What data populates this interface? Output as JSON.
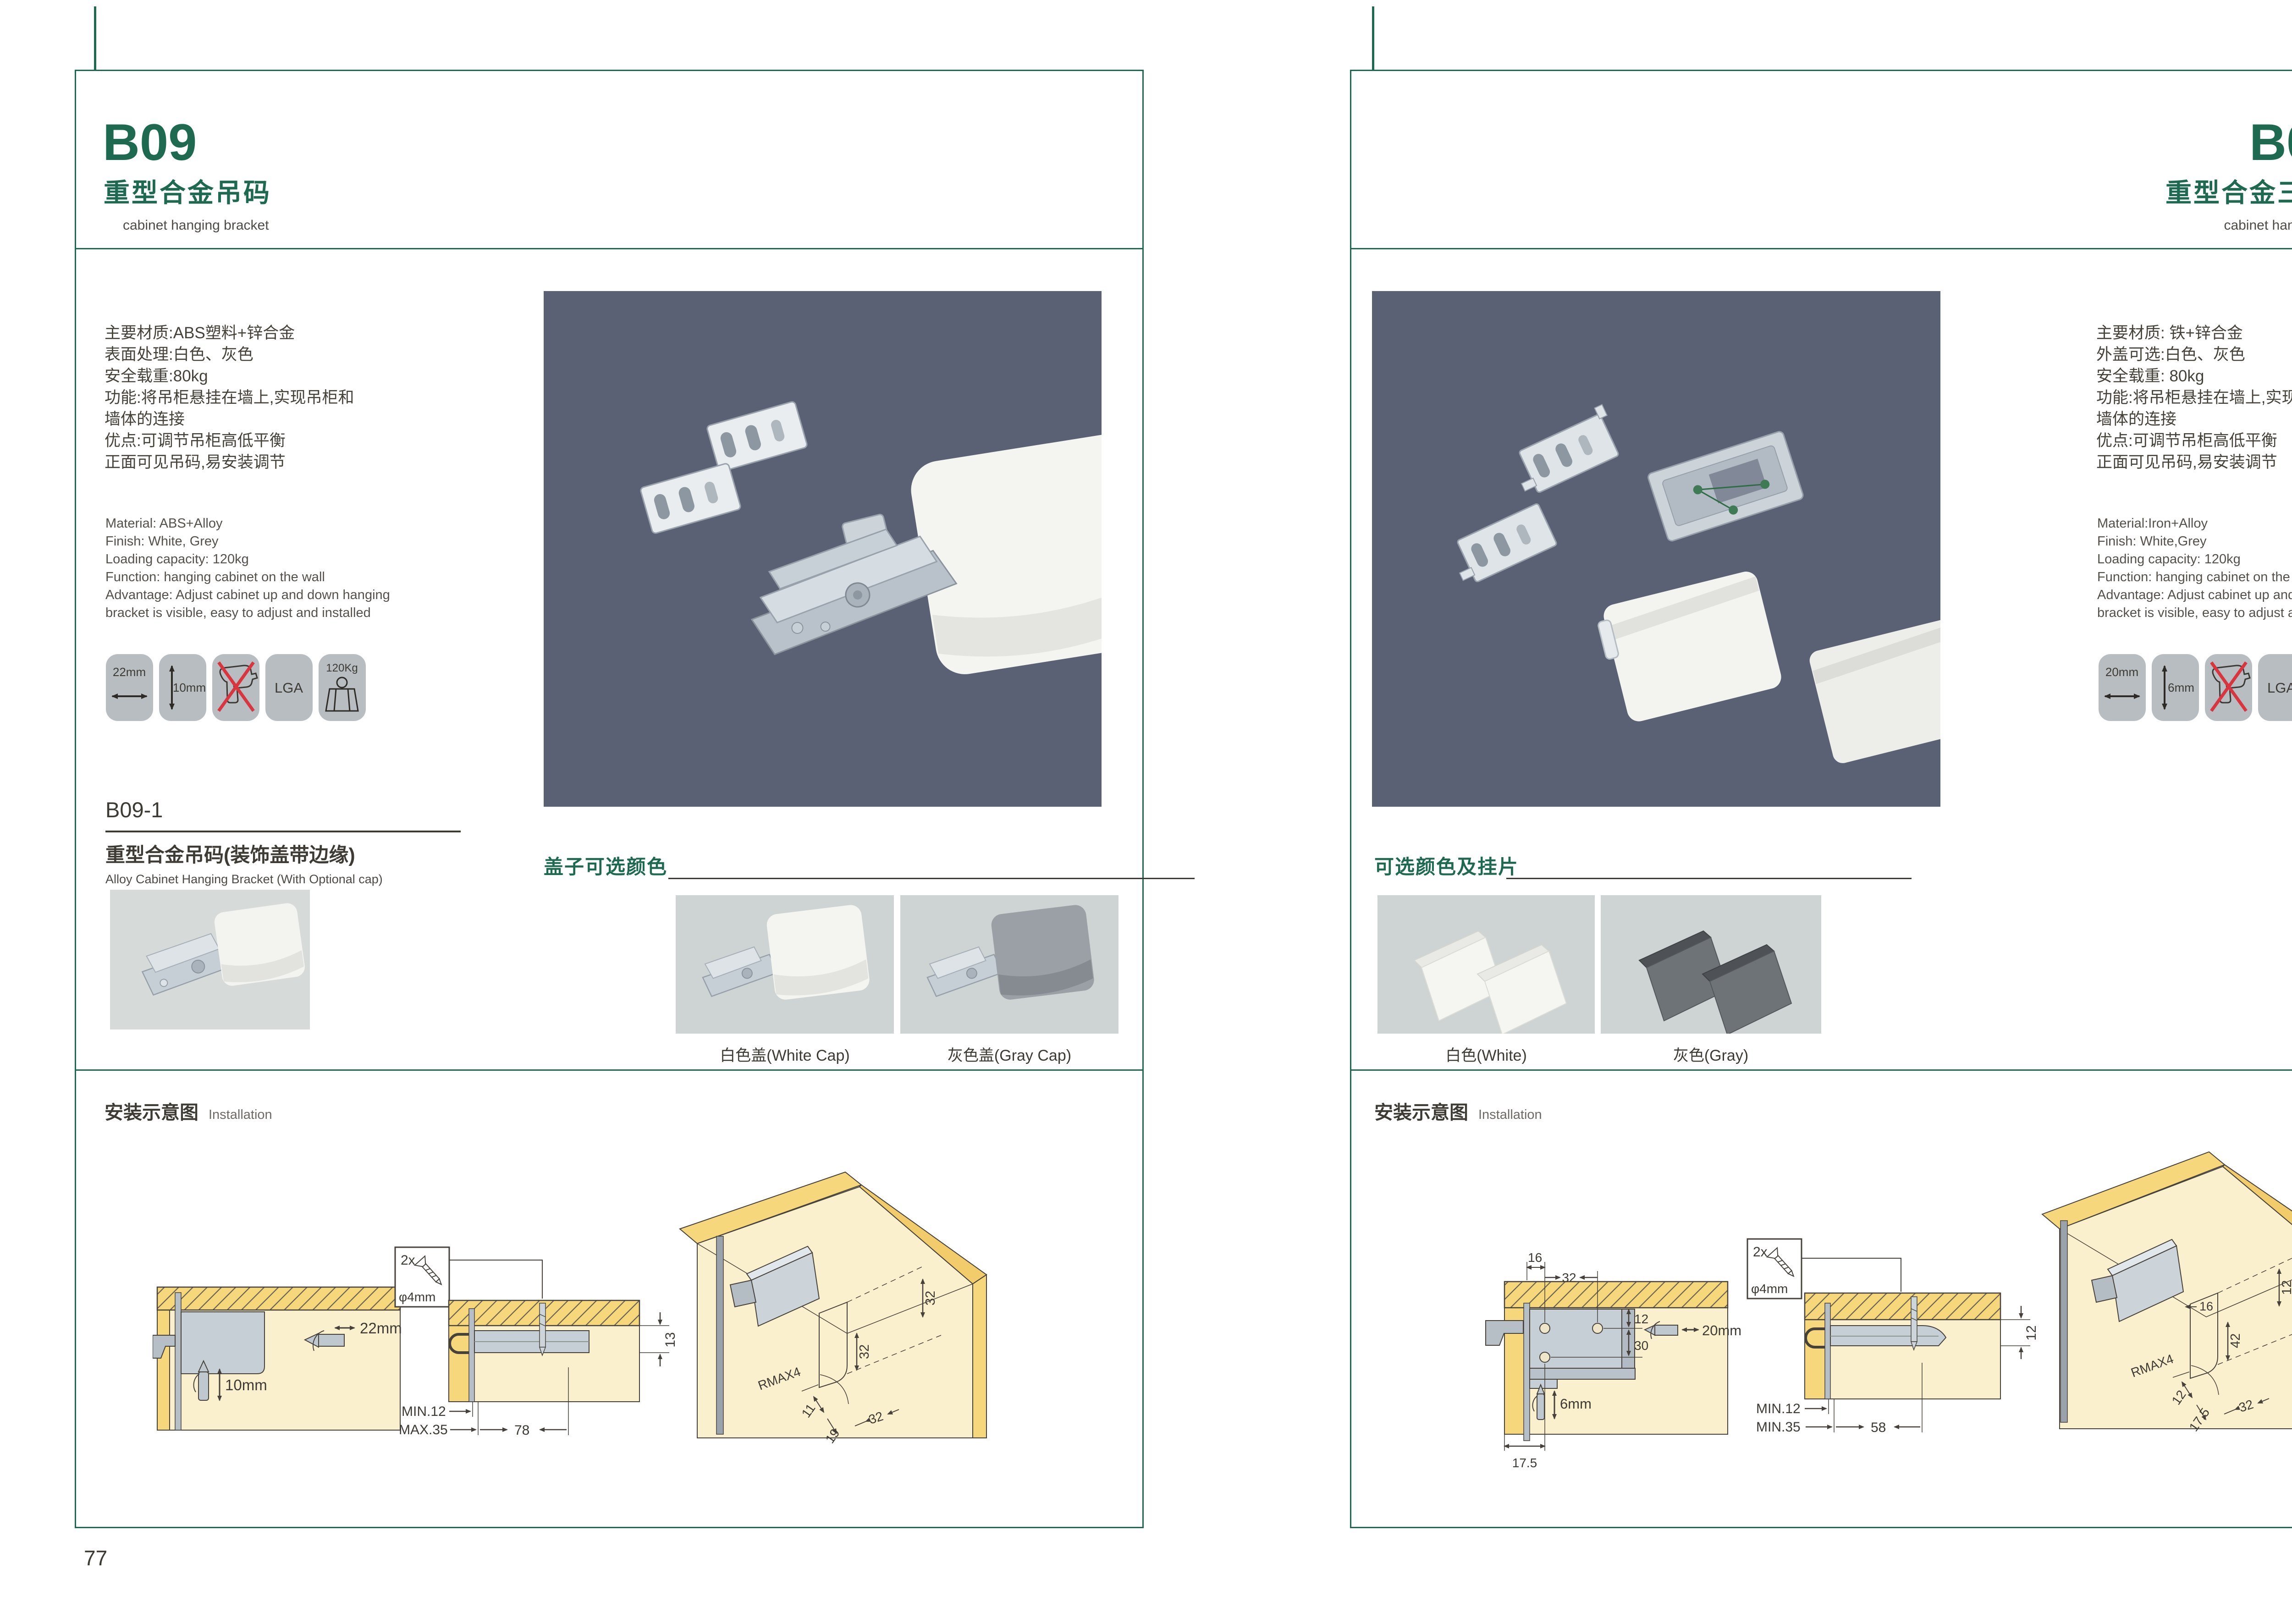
{
  "accent": "#1e6a50",
  "photo_bg_dark": "#5a6174",
  "photo_bg_light": "#d6dbda",
  "left_page": {
    "page_number": "77",
    "code": "B09",
    "title_cn": "重型合金吊码",
    "title_en": "cabinet hanging bracket",
    "specs_cn": "主要材质:ABS塑料+锌合金\n表面处理:白色、灰色\n安全载重:80kg\n功能:将吊柜悬挂在墙上,实现吊柜和\n墙体的连接\n优点:可调节吊柜高低平衡\n正面可见吊码,易安装调节",
    "specs_en": "Material: ABS+Alloy\nFinish: White, Grey\nLoading capacity: 120kg\nFunction: hanging cabinet on the wall\nAdvantage: Adjust cabinet up and down hanging\nbracket is visible, easy to adjust and installed",
    "icons": {
      "width": "22mm",
      "depth": "10mm",
      "lga": "LGA",
      "weight": "120Kg"
    },
    "sub": {
      "code": "B09-1",
      "title_cn": "重型合金吊码(装饰盖带边缘)",
      "title_en": "Alloy Cabinet Hanging Bracket (With Optional cap)"
    },
    "caps": {
      "title": "盖子可选颜色",
      "white": "白色盖(White Cap)",
      "gray": "灰色盖(Gray Cap)"
    },
    "install": {
      "title_cn": "安装示意图",
      "title_en": "Installation",
      "screw": {
        "count": "2x",
        "dia": "φ4mm"
      },
      "d1": {
        "width": "22mm",
        "depth": "10mm"
      },
      "d2": {
        "t": "13",
        "min": "MIN.12",
        "max": "MAX.35",
        "len": "78"
      },
      "d3": {
        "a": "32",
        "b": "32",
        "r": "RMAX4",
        "c": "11",
        "d": "19",
        "e": "32"
      }
    }
  },
  "right_page": {
    "page_number": "78",
    "code": "B09-3",
    "title_cn": "重型合金三孔吊码",
    "title_en": "cabinet hanging bracket",
    "specs_cn": "主要材质: 铁+锌合金\n外盖可选:白色、灰色\n安全载重: 80kg\n功能:将吊柜悬挂在墙上,实现吊柜和\n墙体的连接\n优点:可调节吊柜高低平衡\n正面可见吊码,易安装调节",
    "specs_en": "Material:Iron+Alloy\nFinish: White,Grey\nLoading capacity: 120kg\nFunction: hanging cabinet on the wall\nAdvantage: Adjust cabinet up and down hanging\nbracket is visible, easy to adjust and installed",
    "icons": {
      "width": "20mm",
      "depth": "6mm",
      "lga": "LGA",
      "weight": "120Kg"
    },
    "caps": {
      "title": "可选颜色及挂片",
      "white": "白色(White)",
      "gray": "灰色(Gray)"
    },
    "install": {
      "title_cn": "安装示意图",
      "title_en": "Installation",
      "screw": {
        "count": "2x",
        "dia": "φ4mm"
      },
      "d1": {
        "a": "16",
        "b": "32",
        "c": "12",
        "d": "30",
        "width": "20mm",
        "depth": "6mm",
        "off": "17.5"
      },
      "d2": {
        "t": "12",
        "min": "MIN.12",
        "max": "MIN.35",
        "len": "58"
      },
      "d3": {
        "a": "12",
        "b": "16",
        "c": "42",
        "r": "RMAX4",
        "d": "12",
        "e": "17.5",
        "f": "32"
      }
    }
  }
}
